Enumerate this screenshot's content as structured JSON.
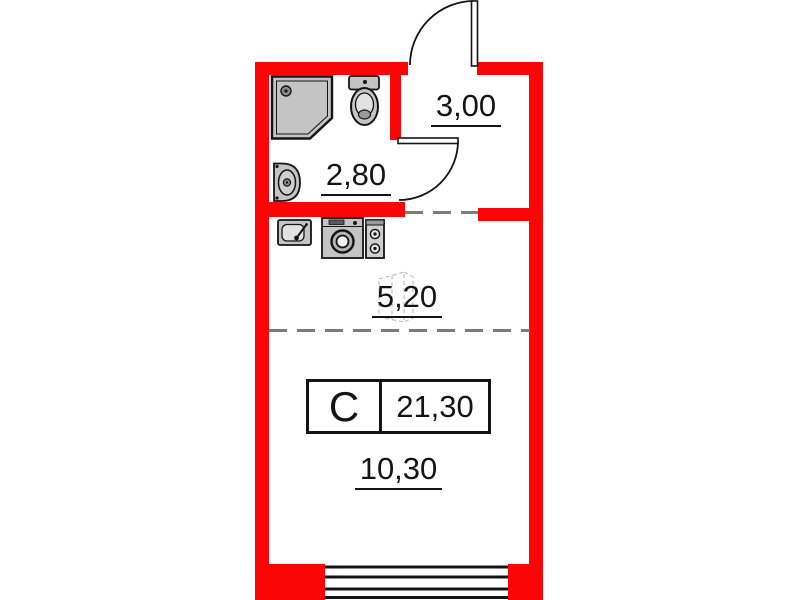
{
  "unit": {
    "type_letter": "С",
    "total_area": "21,30"
  },
  "areas": {
    "hallway": "3,00",
    "bathroom": "2,80",
    "kitchen": "5,20",
    "living_room": "10,30"
  },
  "icons": {
    "shower": "shower-icon",
    "toilet": "toilet-icon",
    "washbasin": "washbasin-icon",
    "kitchen_sink": "kitchen-sink-icon",
    "washing_machine": "washing-machine-icon",
    "stove": "stove-icon",
    "entrance_door": "entrance-door-arc",
    "bathroom_door": "bathroom-door-arc",
    "window": "window-glazing",
    "vent_shaft": "vent-shaft-icon"
  },
  "colors": {
    "wall": "#fb0606",
    "line": "#141414",
    "zone_dash": "#7b7b7b",
    "fixture_fill": "#c4c4c4",
    "background": "#ffffff"
  },
  "window": {
    "pane_lines": 4
  }
}
